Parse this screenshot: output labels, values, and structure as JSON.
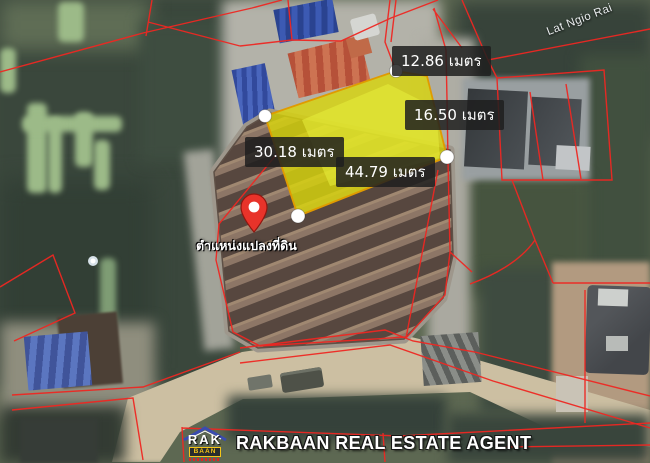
{
  "map": {
    "road_label": "Lat Ngio Rai",
    "pin_label": "ตำแหน่งแปลงที่ดิน",
    "measurements": [
      {
        "side": "top",
        "label": "12.86 เมตร"
      },
      {
        "side": "right",
        "label": "16.50 เมตร"
      },
      {
        "side": "left",
        "label": "30.18 เมตร"
      },
      {
        "side": "bottom",
        "label": "44.79 เมตร"
      }
    ],
    "colors": {
      "parcel_boundary": "#ee2722",
      "highlight_fill": "#d8d40c",
      "highlight_outline": "#e09b00",
      "pin": "#e8332a",
      "vertex_dot": "#ffffff"
    }
  },
  "watermark": {
    "logo_top": "RAK",
    "logo_sub": "BAAN",
    "agency": "RAKBAAN REAL ESTATE AGENT"
  }
}
